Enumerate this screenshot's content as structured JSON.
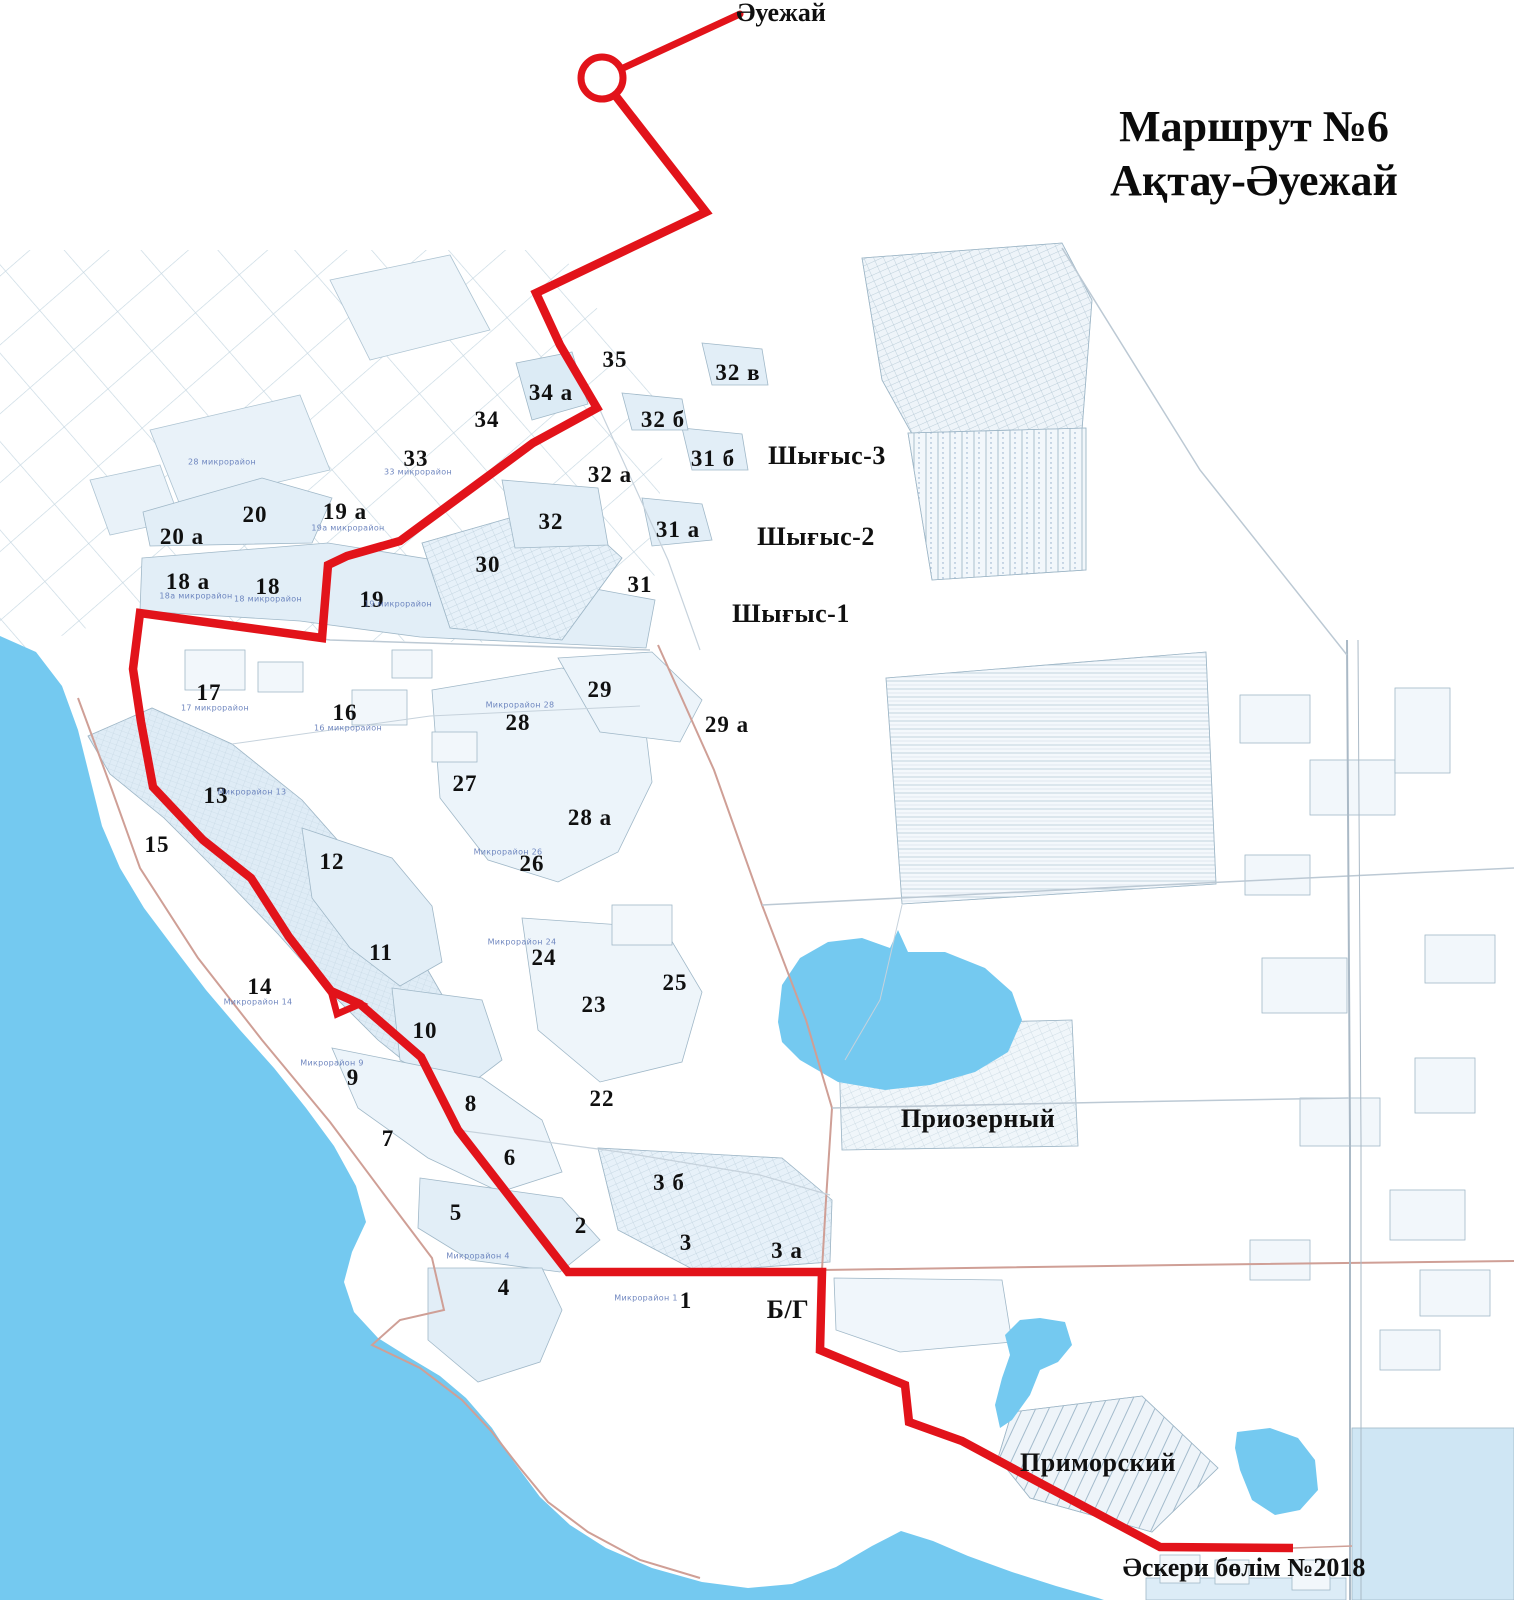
{
  "title": {
    "line1": "Маршрут №6",
    "line2": "Ақтау-Әуежай"
  },
  "map": {
    "colors": {
      "sea": "#74c9f0",
      "block_fill": "#e2eef7",
      "block_border": "#9fb6c8",
      "road": "#bcc9d4",
      "road_accent": "#cf9f96",
      "route": "#e2131a",
      "micro_label": "#5873b5"
    },
    "route": {
      "name": "Маршрут №6 Ақтау-Әуежай",
      "color": "#e2131a",
      "width": 8.5,
      "airport_stop": {
        "label": "Әуежай",
        "cx": 602,
        "cy": 78,
        "r": 21
      },
      "airport_link": [
        [
          621,
          69
        ],
        [
          740,
          14
        ]
      ],
      "points": [
        [
          615,
          95
        ],
        [
          706,
          212
        ],
        [
          536,
          293
        ],
        [
          560,
          345
        ],
        [
          597,
          408
        ],
        [
          533,
          443
        ],
        [
          400,
          541
        ],
        [
          347,
          556
        ],
        [
          328,
          565
        ],
        [
          322,
          638
        ],
        [
          140,
          613
        ],
        [
          133,
          669
        ],
        [
          141,
          722
        ],
        [
          153,
          787
        ],
        [
          203,
          840
        ],
        [
          251,
          878
        ],
        [
          289,
          937
        ],
        [
          331,
          991
        ],
        [
          360,
          1004
        ],
        [
          421,
          1057
        ],
        [
          458,
          1130
        ],
        [
          568,
          1272
        ],
        [
          822,
          1272
        ],
        [
          820,
          1350
        ],
        [
          905,
          1385
        ],
        [
          909,
          1422
        ],
        [
          962,
          1441
        ],
        [
          1055,
          1491
        ],
        [
          1160,
          1547
        ],
        [
          1293,
          1548
        ]
      ],
      "loop": [
        [
          331,
          991
        ],
        [
          337,
          1014
        ],
        [
          360,
          1004
        ]
      ],
      "start_label": "Әуежай",
      "end_label": "Әскери бөлім №2018"
    },
    "labels": {
      "districts": [
        {
          "t": "1",
          "x": 686,
          "y": 1301
        },
        {
          "t": "2",
          "x": 581,
          "y": 1226
        },
        {
          "t": "3",
          "x": 686,
          "y": 1243
        },
        {
          "t": "3 а",
          "x": 787,
          "y": 1251
        },
        {
          "t": "3 б",
          "x": 669,
          "y": 1183
        },
        {
          "t": "4",
          "x": 504,
          "y": 1288
        },
        {
          "t": "5",
          "x": 456,
          "y": 1213
        },
        {
          "t": "6",
          "x": 510,
          "y": 1158
        },
        {
          "t": "7",
          "x": 388,
          "y": 1139
        },
        {
          "t": "8",
          "x": 471,
          "y": 1104
        },
        {
          "t": "9",
          "x": 353,
          "y": 1078
        },
        {
          "t": "10",
          "x": 425,
          "y": 1031
        },
        {
          "t": "11",
          "x": 381,
          "y": 953
        },
        {
          "t": "12",
          "x": 332,
          "y": 862
        },
        {
          "t": "13",
          "x": 216,
          "y": 796
        },
        {
          "t": "14",
          "x": 260,
          "y": 987
        },
        {
          "t": "15",
          "x": 157,
          "y": 845
        },
        {
          "t": "16",
          "x": 345,
          "y": 713
        },
        {
          "t": "17",
          "x": 209,
          "y": 693
        },
        {
          "t": "18",
          "x": 268,
          "y": 587
        },
        {
          "t": "18 а",
          "x": 188,
          "y": 582
        },
        {
          "t": "19",
          "x": 372,
          "y": 600
        },
        {
          "t": "19 а",
          "x": 345,
          "y": 512
        },
        {
          "t": "20",
          "x": 255,
          "y": 515
        },
        {
          "t": "20 а",
          "x": 182,
          "y": 537
        },
        {
          "t": "22",
          "x": 602,
          "y": 1099
        },
        {
          "t": "23",
          "x": 594,
          "y": 1005
        },
        {
          "t": "24",
          "x": 544,
          "y": 958
        },
        {
          "t": "25",
          "x": 675,
          "y": 983
        },
        {
          "t": "26",
          "x": 532,
          "y": 864
        },
        {
          "t": "27",
          "x": 465,
          "y": 784
        },
        {
          "t": "28",
          "x": 518,
          "y": 723
        },
        {
          "t": "28 а",
          "x": 590,
          "y": 818
        },
        {
          "t": "29",
          "x": 600,
          "y": 690
        },
        {
          "t": "29 а",
          "x": 727,
          "y": 725
        },
        {
          "t": "30",
          "x": 488,
          "y": 565
        },
        {
          "t": "31",
          "x": 640,
          "y": 585
        },
        {
          "t": "31 а",
          "x": 678,
          "y": 530
        },
        {
          "t": "31 б",
          "x": 713,
          "y": 459
        },
        {
          "t": "32",
          "x": 551,
          "y": 522
        },
        {
          "t": "32 а",
          "x": 610,
          "y": 475
        },
        {
          "t": "32 б",
          "x": 663,
          "y": 420
        },
        {
          "t": "32 в",
          "x": 738,
          "y": 373
        },
        {
          "t": "33",
          "x": 416,
          "y": 459
        },
        {
          "t": "34",
          "x": 487,
          "y": 420
        },
        {
          "t": "34 а",
          "x": 551,
          "y": 393
        },
        {
          "t": "35",
          "x": 615,
          "y": 360
        }
      ],
      "areas": [
        {
          "t": "Шығыс-3",
          "x": 827,
          "y": 456
        },
        {
          "t": "Шығыс-2",
          "x": 816,
          "y": 537
        },
        {
          "t": "Шығыс-1",
          "x": 791,
          "y": 614
        },
        {
          "t": "Приозерный",
          "x": 978,
          "y": 1119
        },
        {
          "t": "Приморский",
          "x": 1098,
          "y": 1463
        },
        {
          "t": "Б/Г",
          "x": 788,
          "y": 1310
        }
      ],
      "pois": [
        {
          "t": "Әуежай",
          "x": 781,
          "y": 13
        },
        {
          "t": "Әскери бөлім №2018",
          "x": 1244,
          "y": 1568
        }
      ],
      "micro": [
        {
          "t": "28 микрорайон",
          "x": 222,
          "y": 462
        },
        {
          "t": "33 микрорайон",
          "x": 418,
          "y": 472
        },
        {
          "t": "19а микрорайон",
          "x": 348,
          "y": 528
        },
        {
          "t": "18а микрорайон",
          "x": 196,
          "y": 596
        },
        {
          "t": "18 микрорайон",
          "x": 268,
          "y": 599
        },
        {
          "t": "19 микрорайон",
          "x": 398,
          "y": 604
        },
        {
          "t": "17 микрорайон",
          "x": 215,
          "y": 708
        },
        {
          "t": "16 микрорайон",
          "x": 348,
          "y": 728
        },
        {
          "t": "Микрорайон 13",
          "x": 252,
          "y": 792
        },
        {
          "t": "Микрорайон 28",
          "x": 520,
          "y": 705
        },
        {
          "t": "Микрорайон 26",
          "x": 508,
          "y": 852
        },
        {
          "t": "Микрорайон 24",
          "x": 522,
          "y": 942
        },
        {
          "t": "Микрорайон 14",
          "x": 258,
          "y": 1002
        },
        {
          "t": "Микрорайон 9",
          "x": 332,
          "y": 1063
        },
        {
          "t": "Микрорайон 4",
          "x": 478,
          "y": 1256
        },
        {
          "t": "Микрорайон 1",
          "x": 646,
          "y": 1298
        }
      ]
    }
  }
}
